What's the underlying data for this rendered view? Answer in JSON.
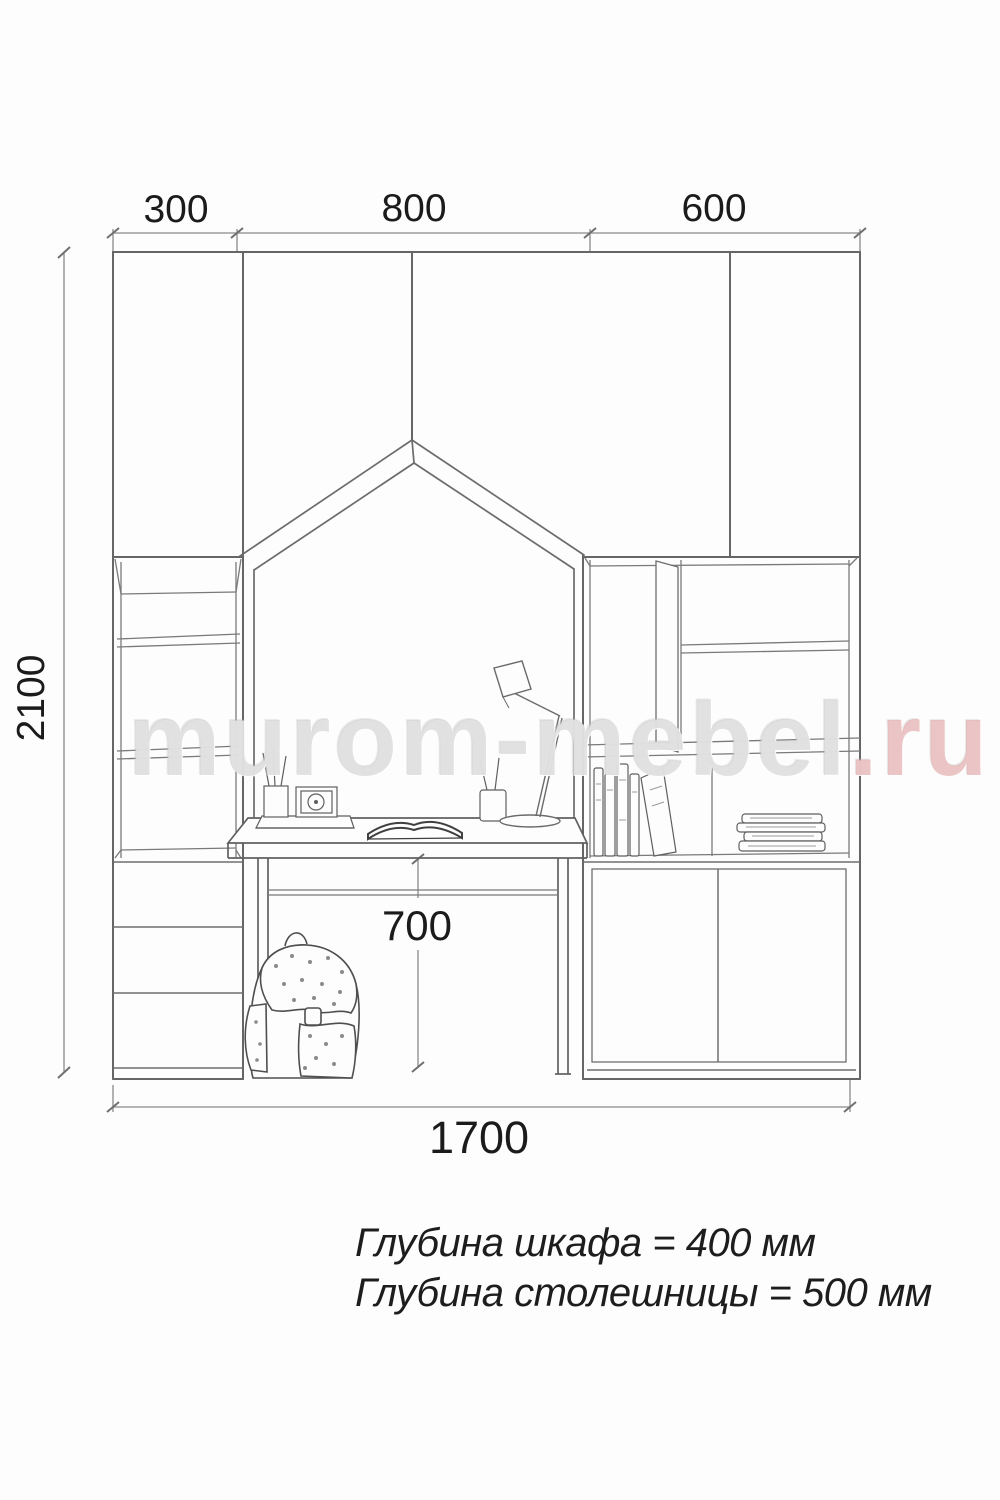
{
  "drawing": {
    "title": "furniture elevation drawing",
    "dimensions": {
      "top": [
        "300",
        "800",
        "600"
      ],
      "height": "2100",
      "under_desk": "700",
      "total_width": "1700"
    },
    "notes": {
      "cabinet_depth": "Глубина шкафа = 400 мм",
      "desktop_depth": "Глубина столешницы = 500 мм"
    },
    "watermark": {
      "main": "murom-mebel",
      "suffix": ".ru"
    },
    "colors": {
      "line": "#6b6b6b",
      "dim_line": "#8a8a8a",
      "text": "#1b1b1b",
      "watermark_gray": "#d0d0d0",
      "watermark_red": "#e2a8a8"
    }
  }
}
